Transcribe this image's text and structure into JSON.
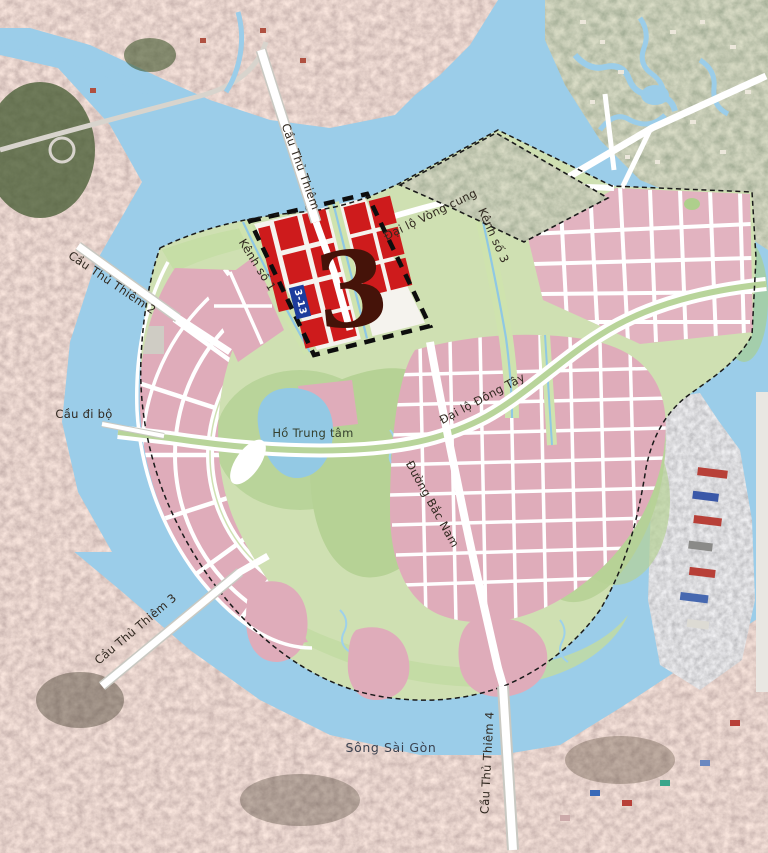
{
  "map": {
    "description": "Thu Thiem new urban area master plan overlaid on satellite imagery, zone 3 highlighted",
    "labels": [
      {
        "id": "bridge-thu-thiem-1",
        "text": "Cầu Thủ Thiêm"
      },
      {
        "id": "bridge-thu-thiem-2",
        "text": "Cầu Thủ Thiêm 2"
      },
      {
        "id": "pedestrian-bridge",
        "text": "Cầu đi bộ"
      },
      {
        "id": "bridge-thu-thiem-3",
        "text": "Cầu Thủ Thiêm 3"
      },
      {
        "id": "bridge-thu-thiem-4",
        "text": "Cầu Thủ Thiêm 4"
      },
      {
        "id": "ring-boulevard",
        "text": "Đại lộ Vòng cung"
      },
      {
        "id": "east-west-boulevard",
        "text": "Đại lộ Đông Tây"
      },
      {
        "id": "north-south-road",
        "text": "Đường Bắc Nam"
      },
      {
        "id": "canal-1",
        "text": "Kênh số 1"
      },
      {
        "id": "canal-3",
        "text": "Kênh số 3"
      },
      {
        "id": "central-lake",
        "text": "Hồ Trung tâm"
      },
      {
        "id": "saigon-river",
        "text": "Sông Sài Gòn"
      }
    ],
    "zone": {
      "number": "3",
      "parcel_marker": "3-13"
    },
    "colors": {
      "water": "#9bcde9",
      "plan_green": "#cfe0b2",
      "marsh_green": "#b6d295",
      "district_pink": "#dfacba",
      "highlight_red": "#ce1b1c",
      "zone_number": "#451309",
      "lake_blue": "#93c9e4",
      "road_white": "#ffffff",
      "parcel_marker_blue": "#1d3c9c",
      "boundary_dash": "#111111"
    }
  }
}
